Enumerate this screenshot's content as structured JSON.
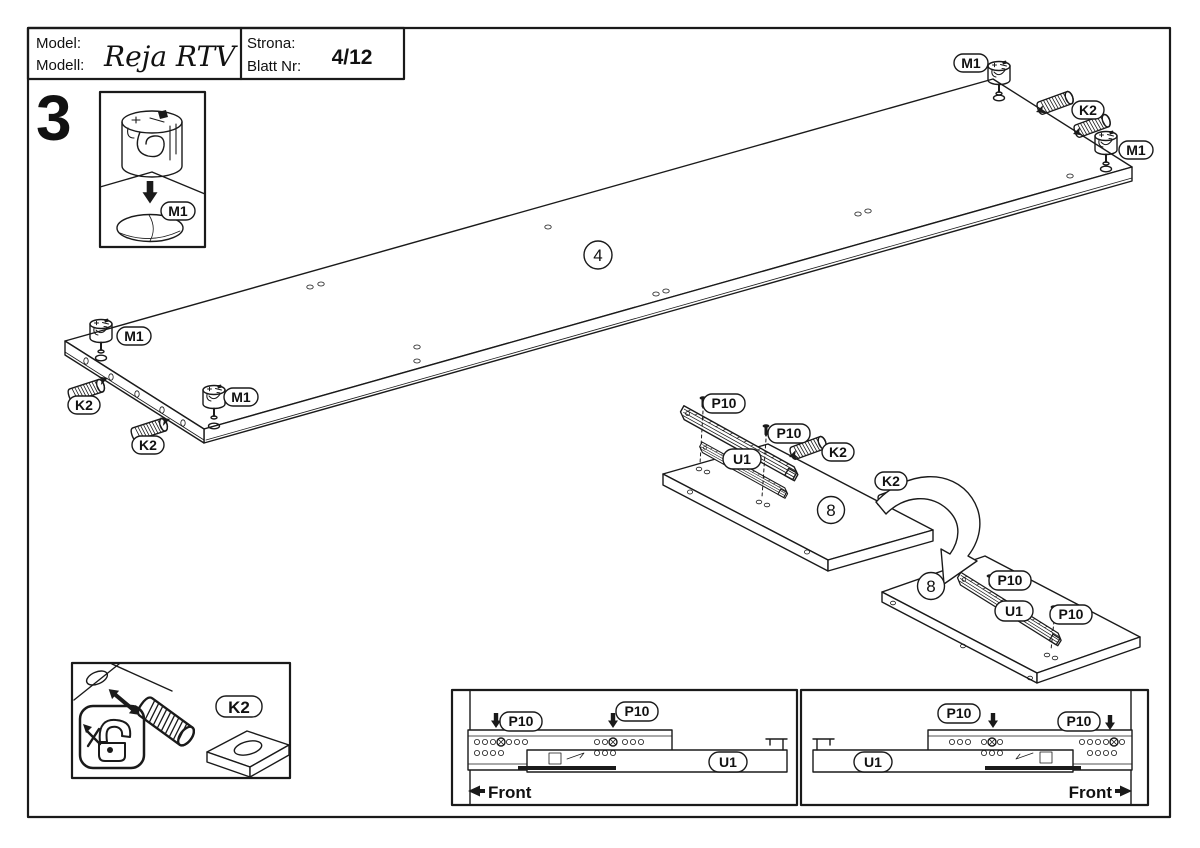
{
  "sheet": {
    "model_label_1": "Model:",
    "model_label_2": "Modell:",
    "model_name": "Reja RTV",
    "page_label_1": "Strona:",
    "page_label_2": "Blatt Nr:",
    "page_value": "4/12",
    "step_number": "3"
  },
  "labels": {
    "cam": "M1",
    "dowel": "K2",
    "screw": "P10",
    "slide": "U1",
    "panel_top": "4",
    "panel_side": "8",
    "front": "Front"
  }
}
